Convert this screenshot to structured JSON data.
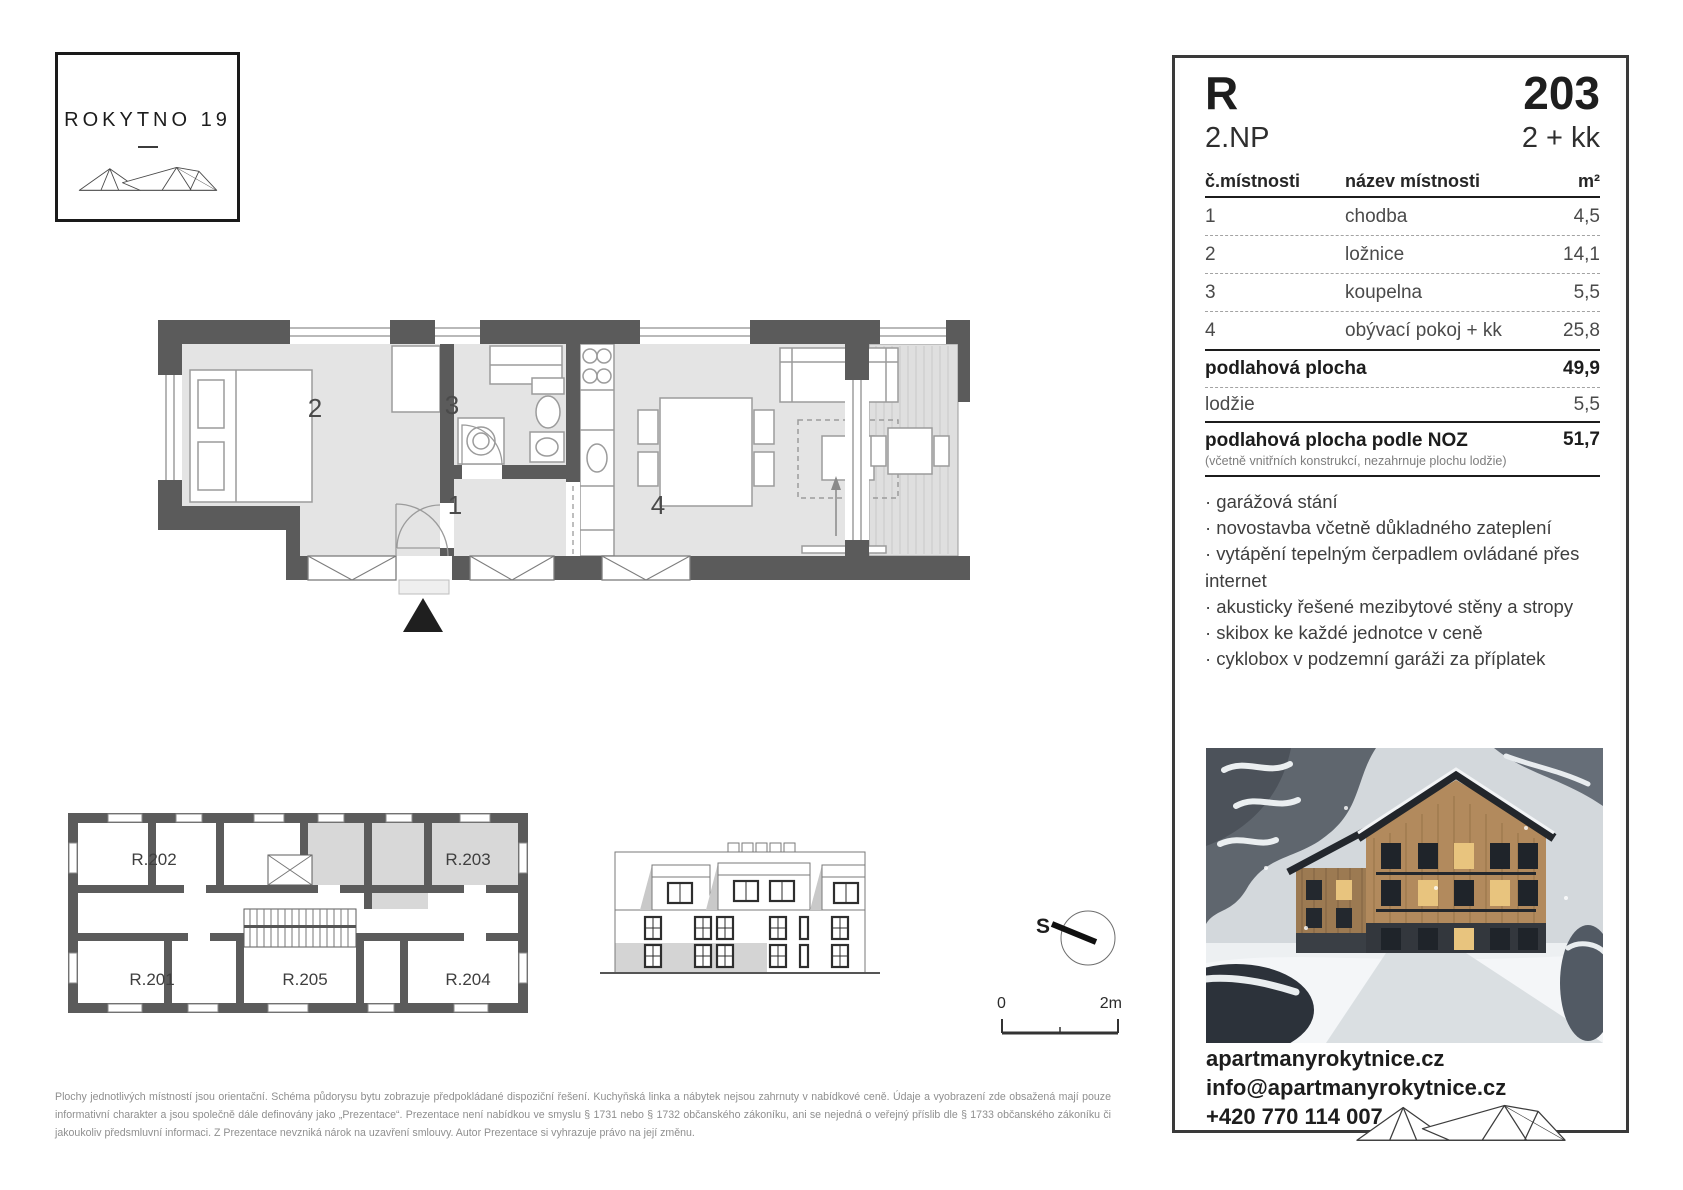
{
  "brand": {
    "name": "ROKYTNO 19"
  },
  "unit": {
    "building_letter": "R",
    "floor": "2.NP",
    "number": "203",
    "disposition": "2 + kk"
  },
  "area_table": {
    "columns": {
      "room_no": "č.místnosti",
      "room_name": "název místnosti",
      "area": "m²"
    },
    "rows": [
      {
        "no": "1",
        "name": "chodba",
        "area": "4,5"
      },
      {
        "no": "2",
        "name": "ložnice",
        "area": "14,1"
      },
      {
        "no": "3",
        "name": "koupelna",
        "area": "5,5"
      },
      {
        "no": "4",
        "name": "obývací pokoj + kk",
        "area": "25,8"
      }
    ],
    "floor_area": {
      "label": "podlahová plocha",
      "value": "49,9"
    },
    "loggia": {
      "label": "lodžie",
      "value": "5,5"
    },
    "noz": {
      "label": "podlahová plocha podle NOZ",
      "note": "(včetně vnitřních konstrukcí, nezahrnuje plochu lodžie)",
      "value": "51,7"
    }
  },
  "features": [
    "· garážová stání",
    "· novostavba včetně důkladného zateplení",
    "· vytápění tepelným čerpadlem ovládané přes internet",
    "· akusticky řešené mezibytové stěny a stropy",
    "· skibox ke každé jednotce v ceně",
    "· cyklobox v podzemní garáži za příplatek"
  ],
  "contact": {
    "web": "apartmanyrokytnice.cz",
    "email": "info@apartmanyrokytnice.cz",
    "phone": "+420 770 114 007"
  },
  "floor_plan": {
    "room_labels": [
      "1",
      "2",
      "3",
      "4"
    ]
  },
  "overview_plan": {
    "units": [
      "R.202",
      "R.203",
      "R.201",
      "R.205",
      "R.204"
    ]
  },
  "compass": {
    "label": "S"
  },
  "scale_bar": {
    "start": "0",
    "end": "2m"
  },
  "disclaimer": "Plochy jednotlivých místností jsou orientační. Schéma půdorysu bytu zobrazuje předpokládané dispoziční řešení. Kuchyňská linka a nábytek nejsou zahrnuty v nabídkové ceně. Údaje a vyobrazení zde obsažená mají pouze informativní charakter a jsou společně dále definovány jako „Prezentace“. Prezentace není nabídkou ve smyslu § 1731 nebo § 1732 občanského zákoníku, ani se nejedná o veřejný příslib dle § 1733 občanského zákoníku či jakoukoliv předsmluvní informaci. Z Prezentace nevzniká nárok na uzavření smlouvy. Autor Prezentace si vyhrazuje právo na její změnu."
}
